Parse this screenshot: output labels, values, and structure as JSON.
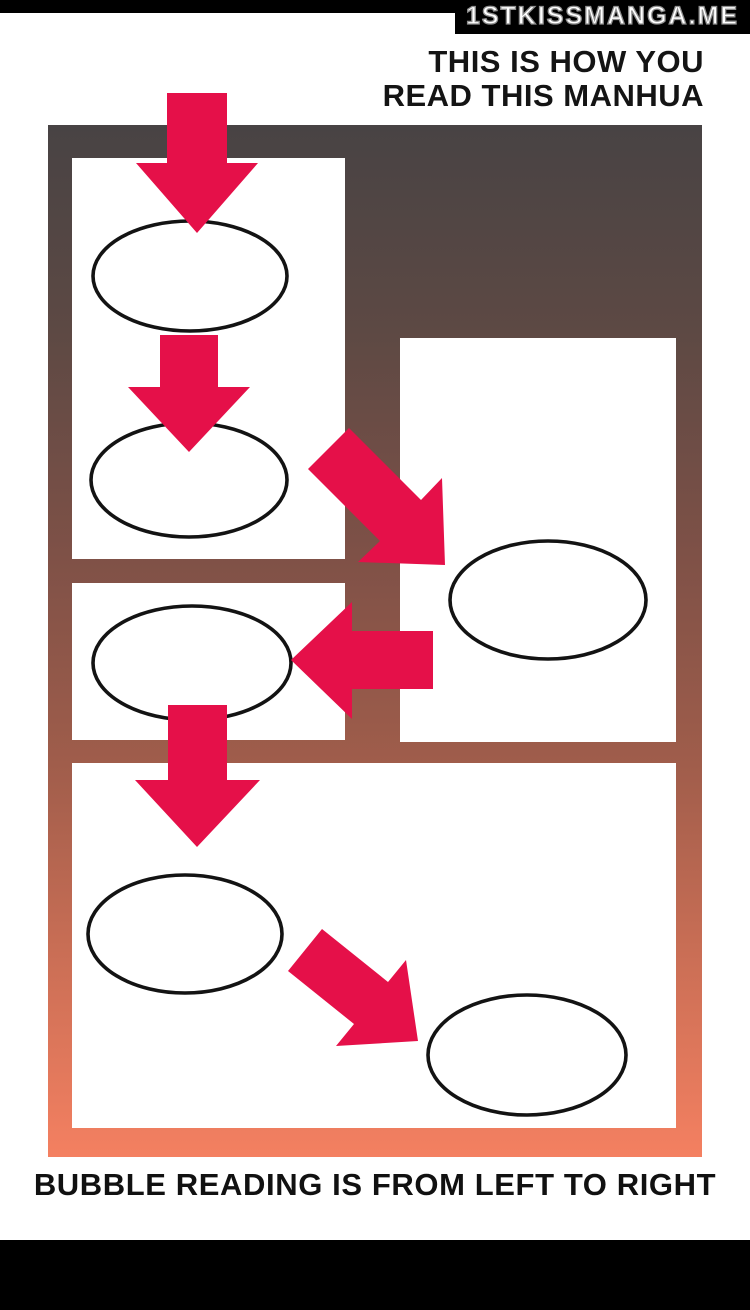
{
  "watermark": {
    "text": "1STKISSMANGA.ME"
  },
  "heading": {
    "line1": "THIS IS HOW YOU",
    "line2": "READ THIS MANHUA"
  },
  "caption": {
    "text": "BUBBLE READING IS FROM LEFT TO RIGHT"
  },
  "colors": {
    "arrow": "#e51049",
    "panel": "#ffffff",
    "bubble_fill": "#ffffff",
    "bubble_stroke": "#131313",
    "bars": "#000000",
    "watermark_fill": "#ffffff",
    "watermark_outline": "#8f8f8f",
    "gradient": [
      "#484344",
      "#5d4944",
      "#7f5147",
      "#a05d4b",
      "#c96e55",
      "#f48061"
    ]
  },
  "diagram": {
    "panel_count": 4,
    "bubble_count": 6,
    "arrows": [
      {
        "icon": "down-arrow-icon",
        "direction": "down"
      },
      {
        "icon": "down-arrow-icon",
        "direction": "down"
      },
      {
        "icon": "down-right-arrow-icon",
        "direction": "down-right"
      },
      {
        "icon": "left-arrow-icon",
        "direction": "left"
      },
      {
        "icon": "down-arrow-icon",
        "direction": "down"
      },
      {
        "icon": "down-right-arrow-icon",
        "direction": "down-right"
      }
    ]
  }
}
